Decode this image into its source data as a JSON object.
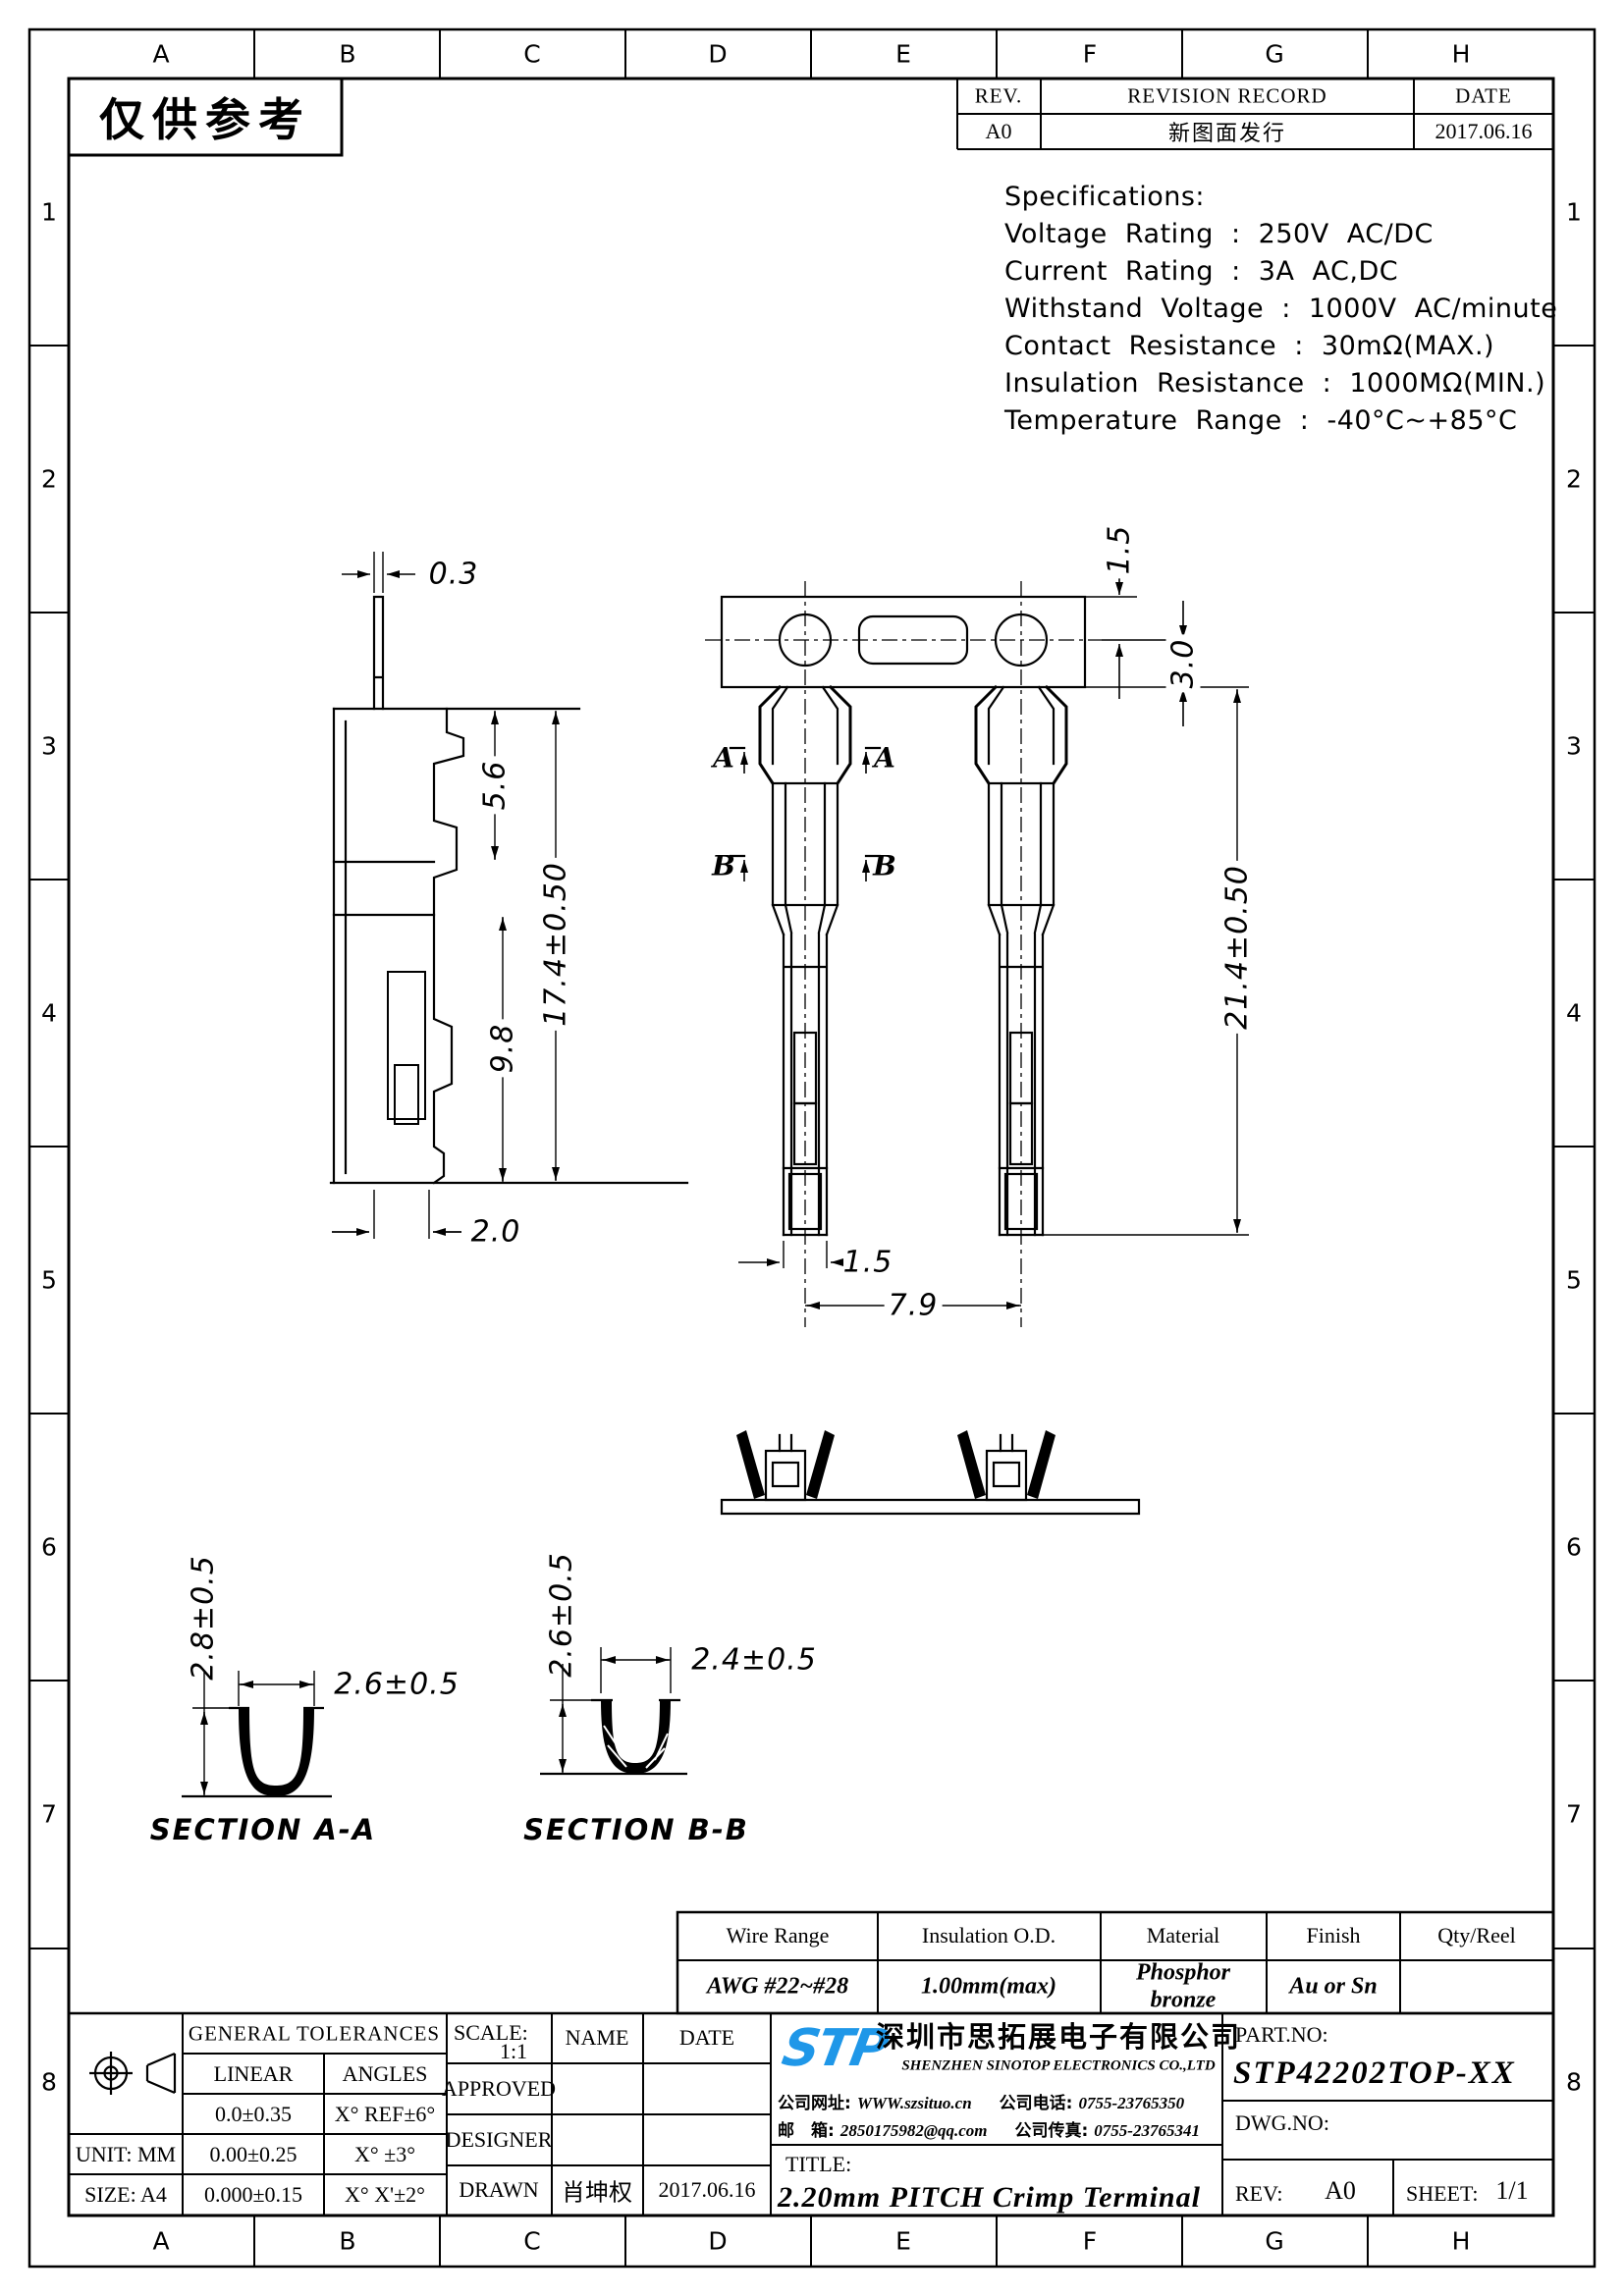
{
  "page": {
    "stamp": "仅供参考"
  },
  "grid": {
    "cols": [
      "A",
      "B",
      "C",
      "D",
      "E",
      "F",
      "G",
      "H"
    ],
    "rows": [
      "1",
      "2",
      "3",
      "4",
      "5",
      "6",
      "7",
      "8"
    ]
  },
  "revision": {
    "rev_header": "REV.",
    "record_header": "REVISION RECORD",
    "date_header": "DATE",
    "rev": "A0",
    "record": "新图面发行",
    "date": "2017.06.16"
  },
  "specs": {
    "title": "Specifications:",
    "lines": [
      "Voltage Rating : 250V AC/DC",
      "Current Rating : 3A AC,DC",
      "Withstand Voltage : 1000V AC/minute",
      "Contact Resistance : 30mΩ(MAX.)",
      "Insulation Resistance : 1000MΩ(MIN.)",
      "Temperature Range : -40°C~+85°C"
    ]
  },
  "dims": {
    "side": {
      "thickness": "0.3",
      "flange": "5.6",
      "body": "9.8",
      "overall": "17.4±0.50",
      "foot": "2.0"
    },
    "front": {
      "margin": "1.5",
      "strip": "3.0",
      "overall": "21.4±0.50",
      "tip": "1.5",
      "pitch": "7.9"
    },
    "section_a": {
      "title": "SECTION A-A",
      "height": "2.8±0.5",
      "width": "2.6±0.5"
    },
    "section_b": {
      "title": "SECTION B-B",
      "height": "2.6±0.5",
      "width": "2.4±0.5"
    },
    "cuts": {
      "a": "A",
      "b": "B"
    }
  },
  "materials": {
    "headers": [
      "Wire Range",
      "Insulation O.D.",
      "Material",
      "Finish",
      "Qty/Reel"
    ],
    "wire_range": "AWG #22~#28",
    "insulation_od": "1.00mm(max)",
    "material": "Phosphor\nbronze",
    "finish": "Au or Sn",
    "qty_reel": ""
  },
  "title_block": {
    "general_tolerances": "GENERAL TOLERANCES",
    "linear": "LINEAR",
    "angles": "ANGLES",
    "lin1": "0.0±0.35",
    "ang1": "X° REF±6°",
    "lin2": "0.00±0.25",
    "ang2": "X° ±3°",
    "lin3": "0.000±0.15",
    "ang3": "X° X'±2°",
    "unit": "UNIT: MM",
    "size": "SIZE: A4",
    "scale_label": "SCALE:",
    "scale": "1:1",
    "name": "NAME",
    "date": "DATE",
    "approved": "APPROVED",
    "designer": "DESIGNER",
    "drawn": "DRAWN",
    "drawn_name": "肖坤权",
    "drawn_date": "2017.06.16",
    "logo": "STP",
    "company_cn": "深圳市思拓展电子有限公司",
    "company_en": "SHENZHEN SINOTOP ELECTRONICS CO.,LTD",
    "web_label": "公司网址:",
    "web": "WWW.szsituo.cn",
    "tel_label": "公司电话:",
    "tel": "0755-23765350",
    "mail_label": "邮　箱:",
    "mail": "2850175982@qq.com",
    "fax_label": "公司传真:",
    "fax": "0755-23765341",
    "part_label": "PART.NO:",
    "part_no": "STP42202TOP-XX",
    "dwg_label": "DWG.NO:",
    "title_label": "TITLE:",
    "title": "2.20mm PITCH Crimp Terminal",
    "rev_label": "REV:",
    "rev": "A0",
    "sheet_label": "SHEET:",
    "sheet": "1/1"
  },
  "colors": {
    "line": "#000000",
    "paper": "#ffffff",
    "logo_blue": "#1f97e8"
  }
}
